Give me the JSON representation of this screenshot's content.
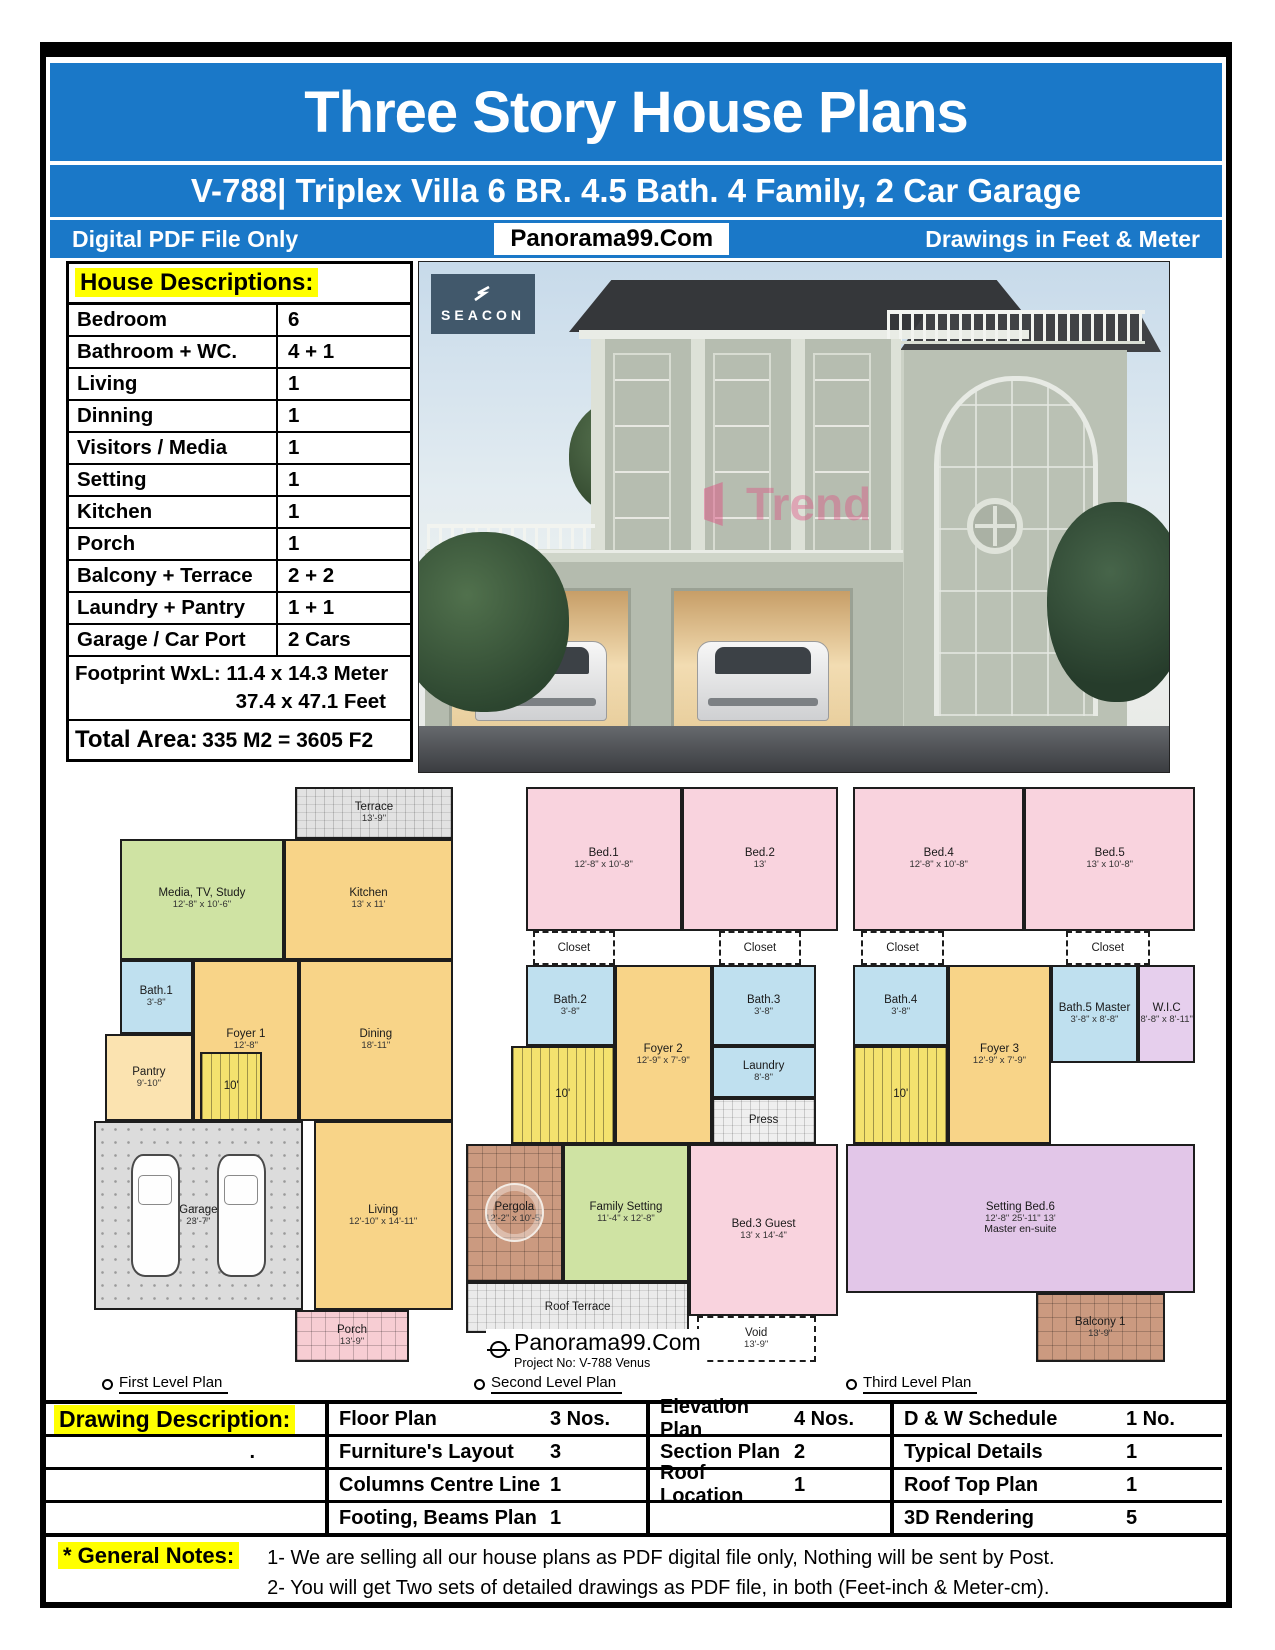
{
  "header": {
    "title": "Three Story House Plans",
    "subtitle": "V-788| Triplex Villa 6 BR. 4.5 Bath. 4 Family, 2 Car Garage",
    "left_note": "Digital PDF File Only",
    "brand": "Panorama99.Com",
    "right_note": "Drawings in Feet & Meter",
    "accent_color": "#1a78c8",
    "highlight_color": "#ffff00"
  },
  "house_descriptions": {
    "title": "House Descriptions:",
    "rows": [
      {
        "label": "Bedroom",
        "value": "6"
      },
      {
        "label": "Bathroom + WC.",
        "value": "4 + 1"
      },
      {
        "label": "Living",
        "value": "1"
      },
      {
        "label": "Dinning",
        "value": "1"
      },
      {
        "label": "Visitors / Media",
        "value": "1"
      },
      {
        "label": "Setting",
        "value": "1"
      },
      {
        "label": "Kitchen",
        "value": "1"
      },
      {
        "label": "Porch",
        "value": "1"
      },
      {
        "label": "Balcony + Terrace",
        "value": "2  + 2"
      },
      {
        "label": "Laundry + Pantry",
        "value": "1  + 1"
      },
      {
        "label": "Garage / Car Port",
        "value": "2 Cars"
      }
    ],
    "footprint_label": "Footprint WxL: 11.4 x 14.3 Meter",
    "footprint_feet": "37.4 x 47.1 Feet",
    "total_label": "Total Area:",
    "total_value": "335 M2 = 3605 F2"
  },
  "photo": {
    "logo_text": "SEACON",
    "watermark": "Trend"
  },
  "plans": [
    {
      "label": "First Level Plan",
      "rooms": [
        {
          "name": "Terrace",
          "dim": "13'-9\"",
          "x": 55,
          "y": 0,
          "w": 43,
          "h": 9,
          "color": "#e2e2e2",
          "pattern": "hatch"
        },
        {
          "name": "Media, TV, Study",
          "dim": "12'-8\" x 10'-6\"",
          "x": 7,
          "y": 9,
          "w": 45,
          "h": 21,
          "color": "#cfe3a3"
        },
        {
          "name": "Kitchen",
          "dim": "13' x 11'",
          "x": 52,
          "y": 9,
          "w": 46,
          "h": 21,
          "color": "#f8d488"
        },
        {
          "name": "Bath.1",
          "dim": "3'-8\"",
          "x": 7,
          "y": 30,
          "w": 20,
          "h": 13,
          "color": "#bfe0ef"
        },
        {
          "name": "Foyer 1",
          "dim": "12'-8\"",
          "x": 27,
          "y": 30,
          "w": 29,
          "h": 28,
          "color": "#f8d488"
        },
        {
          "name": "Dining",
          "dim": "18'-11\"",
          "x": 56,
          "y": 30,
          "w": 42,
          "h": 28,
          "color": "#f8d488"
        },
        {
          "name": "Pantry",
          "dim": "9'-10\"",
          "x": 3,
          "y": 43,
          "w": 24,
          "h": 15,
          "color": "#fbe3b0"
        },
        {
          "name": "10'",
          "x": 29,
          "y": 46,
          "w": 17,
          "h": 12,
          "color": "#f4e26e",
          "pattern": "stairs"
        },
        {
          "name": "Garage",
          "dim": "23'-7\"",
          "x": 0,
          "y": 58,
          "w": 57,
          "h": 33,
          "color": "#dcdcdc",
          "pattern": "dots",
          "icon": "cars"
        },
        {
          "name": "Living",
          "dim": "12'-10\" x 14'-11\"",
          "x": 60,
          "y": 58,
          "w": 38,
          "h": 33,
          "color": "#f8d488"
        },
        {
          "name": "Porch",
          "dim": "13'-9\"",
          "x": 55,
          "y": 91,
          "w": 31,
          "h": 9,
          "color": "#f7cdd3",
          "pattern": "grid"
        }
      ]
    },
    {
      "label": "Second Level Plan",
      "brand": "Panorama99.Com",
      "project": "Project No: V-788 Venus",
      "rooms": [
        {
          "name": "Bed.1",
          "dim": "12'-8\" x 10'-8\"",
          "x": 16,
          "y": 0,
          "w": 42,
          "h": 25,
          "color": "#f9d3de"
        },
        {
          "name": "Bed.2",
          "dim": "13'",
          "x": 58,
          "y": 0,
          "w": 42,
          "h": 25,
          "color": "#f9d3de"
        },
        {
          "name": "Closet",
          "x": 18,
          "y": 25,
          "w": 22,
          "h": 6,
          "color": "#ffffff",
          "dashed": true
        },
        {
          "name": "Closet",
          "x": 68,
          "y": 25,
          "w": 22,
          "h": 6,
          "color": "#ffffff",
          "dashed": true
        },
        {
          "name": "Bath.2",
          "dim": "3'-8\"",
          "x": 16,
          "y": 31,
          "w": 24,
          "h": 14,
          "color": "#bfe0ef"
        },
        {
          "name": "Foyer 2",
          "dim": "12'-9\" x 7'-9\"",
          "x": 40,
          "y": 31,
          "w": 26,
          "h": 31,
          "color": "#f8d488"
        },
        {
          "name": "Bath.3",
          "dim": "3'-8\"",
          "x": 66,
          "y": 31,
          "w": 28,
          "h": 14,
          "color": "#bfe0ef"
        },
        {
          "name": "10'",
          "x": 12,
          "y": 45,
          "w": 28,
          "h": 17,
          "color": "#f4e26e",
          "pattern": "stairs"
        },
        {
          "name": "Laundry",
          "dim": "8'-8\"",
          "x": 66,
          "y": 45,
          "w": 28,
          "h": 9,
          "color": "#bfe0ef"
        },
        {
          "name": "Press",
          "x": 66,
          "y": 54,
          "w": 28,
          "h": 8,
          "color": "#efefef",
          "pattern": "hatch"
        },
        {
          "name": "Pergola",
          "dim": "12'-2\" x 10'-5\"",
          "x": 0,
          "y": 62,
          "w": 26,
          "h": 24,
          "color": "#cb9a80",
          "pattern": "grid",
          "icon": "dome"
        },
        {
          "name": "Family Setting",
          "dim": "11'-4\" x 12'-8\"",
          "x": 26,
          "y": 62,
          "w": 34,
          "h": 24,
          "color": "#cfe3a3"
        },
        {
          "name": "Bed.3 Guest",
          "dim": "13' x 14'-4\"",
          "x": 60,
          "y": 62,
          "w": 40,
          "h": 30,
          "color": "#f9d3de"
        },
        {
          "name": "Roof Terrace",
          "x": 0,
          "y": 86,
          "w": 60,
          "h": 9,
          "color": "#ebebeb",
          "pattern": "hatch"
        },
        {
          "name": "Void",
          "dim": "13'-9\"",
          "x": 62,
          "y": 92,
          "w": 32,
          "h": 8,
          "color": "#ffffff",
          "dashed": true
        }
      ]
    },
    {
      "label": "Third Level Plan",
      "rooms": [
        {
          "name": "Bed.4",
          "dim": "12'-8\" x 10'-8\"",
          "x": 4,
          "y": 0,
          "w": 45,
          "h": 25,
          "color": "#f9d3de"
        },
        {
          "name": "Bed.5",
          "dim": "13' x 10'-8\"",
          "x": 49,
          "y": 0,
          "w": 45,
          "h": 25,
          "color": "#f9d3de"
        },
        {
          "name": "Closet",
          "x": 6,
          "y": 25,
          "w": 22,
          "h": 6,
          "color": "#ffffff",
          "dashed": true
        },
        {
          "name": "Closet",
          "x": 60,
          "y": 25,
          "w": 22,
          "h": 6,
          "color": "#ffffff",
          "dashed": true
        },
        {
          "name": "Bath.4",
          "dim": "3'-8\"",
          "x": 4,
          "y": 31,
          "w": 25,
          "h": 14,
          "color": "#bfe0ef"
        },
        {
          "name": "Foyer 3",
          "dim": "12'-9\" x 7'-9\"",
          "x": 29,
          "y": 31,
          "w": 27,
          "h": 31,
          "color": "#f8d488"
        },
        {
          "name": "Bath.5 Master",
          "dim": "3'-8\" x 8'-8\"",
          "x": 56,
          "y": 31,
          "w": 23,
          "h": 17,
          "color": "#bfe0ef"
        },
        {
          "name": "W.I.C",
          "dim": "8'-8\" x 8'-11\"",
          "x": 79,
          "y": 31,
          "w": 15,
          "h": 17,
          "color": "#e6cfed"
        },
        {
          "name": "10'",
          "x": 4,
          "y": 45,
          "w": 25,
          "h": 17,
          "color": "#f4e26e",
          "pattern": "stairs"
        },
        {
          "name": "Setting      Bed.6",
          "dim": "12'-8\"   25'-11\"   13'",
          "sub": "Master en-suite",
          "x": 2,
          "y": 62,
          "w": 92,
          "h": 26,
          "color": "#e2c6e8"
        },
        {
          "name": "Balcony 1",
          "dim": "13'-9\"",
          "x": 52,
          "y": 88,
          "w": 34,
          "h": 12,
          "color": "#cb9a80",
          "pattern": "grid"
        }
      ]
    }
  ],
  "drawing_table": {
    "col1": {
      "title": "Drawing Description:",
      "row2": "."
    },
    "columns": [
      {
        "rows": [
          {
            "label": "Floor Plan",
            "value": "3 Nos."
          },
          {
            "label": "Furniture's Layout",
            "value": "3"
          },
          {
            "label": "Columns Centre Line",
            "value": "1"
          },
          {
            "label": "Footing, Beams Plan",
            "value": "1"
          }
        ]
      },
      {
        "rows": [
          {
            "label": "Elevation Plan",
            "value": "4 Nos."
          },
          {
            "label": "Section Plan",
            "value": "2"
          },
          {
            "label": "Roof Location",
            "value": "1"
          },
          {
            "label": "",
            "value": ""
          }
        ]
      },
      {
        "rows": [
          {
            "label": "D & W Schedule",
            "value": "1 No."
          },
          {
            "label": "Typical Details",
            "value": "1"
          },
          {
            "label": "Roof Top Plan",
            "value": "1"
          },
          {
            "label": "3D Rendering",
            "value": "5"
          }
        ]
      }
    ]
  },
  "general_notes": {
    "label": "* General Notes:",
    "notes": [
      "1- We are selling all our house plans as PDF digital file only, Nothing will be sent by Post.",
      "2- You will get Two sets of detailed drawings as PDF file, in both (Feet-inch & Meter-cm)."
    ]
  }
}
